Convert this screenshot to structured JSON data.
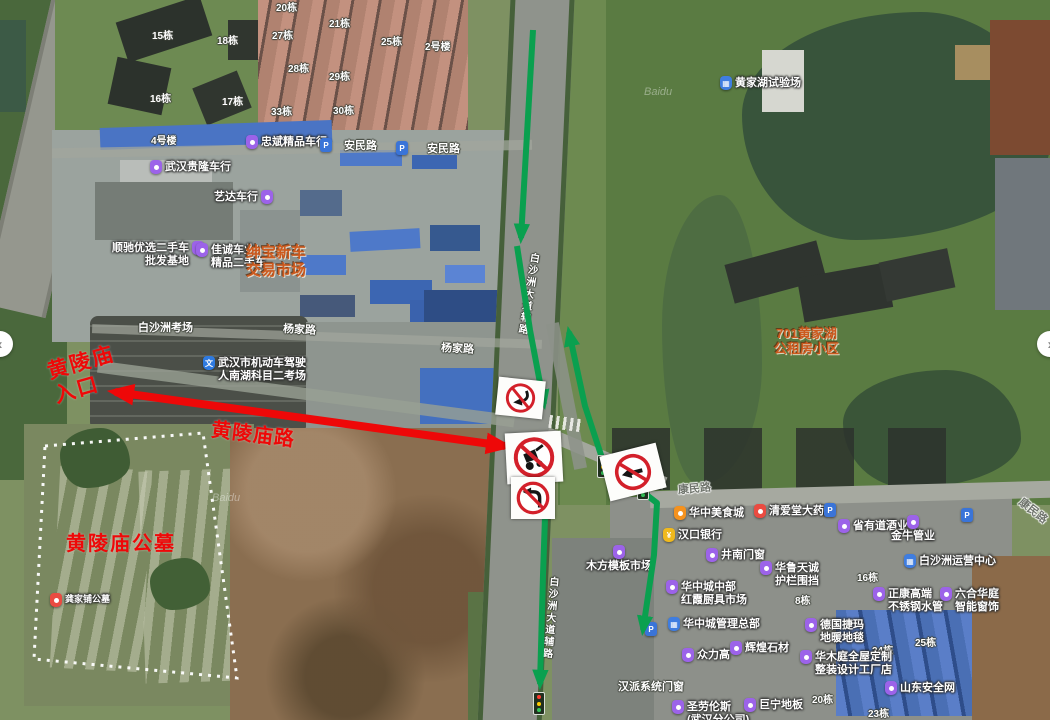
{
  "map": {
    "watermark_text": "Baidu",
    "watermarks": [
      {
        "x": 644,
        "y": 86
      },
      {
        "x": 212,
        "y": 492
      }
    ],
    "controls": {
      "pan_left_glyph": "‹",
      "pan_right_glyph": "›"
    },
    "colors": {
      "annotation_red": "#ee0808",
      "route_green": "#0aa04f",
      "annotation_orange": "#cd5a1e",
      "prohibition_red": "#d3202a"
    },
    "labels": [
      {
        "name": "building-15",
        "type": "bld",
        "x": 152,
        "y": 31,
        "text": "15栋"
      },
      {
        "name": "building-18",
        "type": "bld",
        "x": 217,
        "y": 36,
        "text": "18栋"
      },
      {
        "name": "building-20",
        "type": "bld",
        "x": 276,
        "y": 3,
        "text": "20栋"
      },
      {
        "name": "building-27",
        "type": "bld",
        "x": 272,
        "y": 31,
        "text": "27栋"
      },
      {
        "name": "building-21",
        "type": "bld",
        "x": 329,
        "y": 19,
        "text": "21栋"
      },
      {
        "name": "building-28",
        "type": "bld",
        "x": 288,
        "y": 64,
        "text": "28栋"
      },
      {
        "name": "building-29",
        "type": "bld",
        "x": 329,
        "y": 72,
        "text": "29栋"
      },
      {
        "name": "building-16",
        "type": "bld",
        "x": 150,
        "y": 94,
        "text": "16栋"
      },
      {
        "name": "building-17",
        "type": "bld",
        "x": 222,
        "y": 97,
        "text": "17栋"
      },
      {
        "name": "building-33",
        "type": "bld",
        "x": 271,
        "y": 107,
        "text": "33栋"
      },
      {
        "name": "building-30",
        "type": "bld",
        "x": 333,
        "y": 106,
        "text": "30栋"
      },
      {
        "name": "building-25",
        "type": "bld",
        "x": 381,
        "y": 37,
        "text": "25栋"
      },
      {
        "name": "building-2hao",
        "type": "bld",
        "x": 425,
        "y": 42,
        "text": "2号楼"
      },
      {
        "name": "building-4hao",
        "type": "bld",
        "x": 151,
        "y": 136,
        "text": "4号楼"
      },
      {
        "name": "building-16b",
        "type": "bld",
        "x": 857,
        "y": 573,
        "text": "16栋"
      },
      {
        "name": "building-8",
        "type": "bld",
        "x": 795,
        "y": 596,
        "text": "8栋"
      },
      {
        "name": "building-24",
        "type": "bld",
        "x": 872,
        "y": 646,
        "text": "24栋"
      },
      {
        "name": "building-25b",
        "type": "bld",
        "x": 915,
        "y": 638,
        "text": "25栋"
      },
      {
        "name": "building-20b",
        "type": "bld",
        "x": 812,
        "y": 695,
        "text": "20栋"
      },
      {
        "name": "building-23",
        "type": "bld",
        "x": 868,
        "y": 709,
        "text": "23栋"
      },
      {
        "name": "label-baishazhou-kaochang",
        "type": "road",
        "x": 138,
        "y": 322,
        "text": "白沙洲考场"
      },
      {
        "name": "label-hanpai-doors",
        "type": "road",
        "x": 618,
        "y": 681,
        "text": "汉派系统门窗"
      },
      {
        "name": "road-anmin-1",
        "type": "road",
        "x": 344,
        "y": 140,
        "text": "安民路"
      },
      {
        "name": "road-anmin-2",
        "type": "road",
        "x": 427,
        "y": 143,
        "text": "安民路"
      },
      {
        "name": "road-yangjia-1",
        "type": "road",
        "x": 283,
        "y": 324,
        "rotate": 3,
        "text": "杨家路"
      },
      {
        "name": "road-yangjia-2",
        "type": "road",
        "x": 441,
        "y": 343,
        "rotate": 3,
        "text": "杨家路"
      },
      {
        "name": "road-kangmin-1",
        "type": "roadg",
        "x": 678,
        "y": 483,
        "rotate": -5,
        "text": "康民路"
      },
      {
        "name": "road-kangmin-2",
        "type": "roadg",
        "x": 1016,
        "y": 505,
        "rotate": 38,
        "text": "康民路"
      },
      {
        "name": "road-baishazhou-fulu-north",
        "type": "vroad",
        "x": 521,
        "y": 252,
        "rotate": 9,
        "text": "白沙洲大道辅路"
      },
      {
        "name": "road-baishazhou-fulu-south",
        "type": "vroad",
        "x": 543,
        "y": 576,
        "rotate": 5,
        "text": "白沙洲大道辅路"
      },
      {
        "name": "poi-zhongbin-car",
        "type": "poi",
        "x": 246,
        "y": 136,
        "pin": "purple",
        "text": "忠斌精品车行",
        "interactable": true
      },
      {
        "name": "poi-parking-anmin-1",
        "type": "poi",
        "x": 320,
        "y": 139,
        "pin": "bluep",
        "glyph": "P",
        "text": "",
        "interactable": true
      },
      {
        "name": "poi-parking-anmin-2",
        "type": "poi",
        "x": 396,
        "y": 142,
        "pin": "bluep",
        "glyph": "P",
        "text": "",
        "interactable": true
      },
      {
        "name": "poi-guilong-car",
        "type": "poi",
        "x": 150,
        "y": 161,
        "pin": "purple",
        "text": "武汉贵隆车行",
        "interactable": true
      },
      {
        "name": "poi-yida-car",
        "type": "poi",
        "x": 214,
        "y": 191,
        "pin": "purple",
        "pinSide": "right",
        "text": "艺达车行",
        "interactable": true
      },
      {
        "name": "poi-shunchi-used-cars",
        "type": "poi",
        "x": 112,
        "y": 242,
        "pin": "purple",
        "pinSide": "right",
        "align": "right",
        "lines": [
          "顺驰优选二手车",
          "批发基地"
        ],
        "interactable": true
      },
      {
        "name": "poi-jiacheng-car",
        "type": "poi",
        "x": 196,
        "y": 244,
        "pin": "purple",
        "lines": [
          "佳诚车业",
          "精品二手车"
        ],
        "interactable": true
      },
      {
        "name": "poi-driving-exam-site",
        "type": "poi",
        "x": 203,
        "y": 357,
        "pin": "bluew",
        "glyph": "文",
        "lines": [
          "武汉市机动车驾驶",
          "人南湖科目二考场"
        ],
        "interactable": true
      },
      {
        "name": "poi-huangjiahu-test-ground",
        "type": "poi",
        "x": 720,
        "y": 77,
        "pin": "bluebldg",
        "glyph": "▦",
        "text": "黄家湖试验场",
        "interactable": true
      },
      {
        "name": "poi-huazhong-food-city",
        "type": "poi",
        "x": 674,
        "y": 507,
        "pin": "orange",
        "text": "华中美食城",
        "interactable": true
      },
      {
        "name": "poi-qingaitang-pharmacy",
        "type": "poi",
        "x": 754,
        "y": 505,
        "pin": "red",
        "text": "清爱堂大药房",
        "interactable": true
      },
      {
        "name": "poi-hankou-bank",
        "type": "poi",
        "x": 663,
        "y": 529,
        "pin": "yellow",
        "glyph": "¥",
        "text": "汉口银行",
        "interactable": true
      },
      {
        "name": "poi-shengyoudao-liquor",
        "type": "poi",
        "x": 838,
        "y": 520,
        "pin": "purple",
        "text": "省有道酒业",
        "interactable": true
      },
      {
        "name": "poi-jinniu-pipes",
        "type": "poi",
        "x": 891,
        "y": 516,
        "pin": "purple",
        "pinPos": "top",
        "text": "金牛管业",
        "interactable": true
      },
      {
        "name": "poi-baishazhou-operations-center",
        "type": "poi",
        "x": 904,
        "y": 555,
        "pin": "bluebldg",
        "glyph": "▦",
        "text": "白沙洲运营中心",
        "interactable": true
      },
      {
        "name": "poi-jingnan-doors",
        "type": "poi",
        "x": 706,
        "y": 549,
        "pin": "purple",
        "text": "井南门窗",
        "interactable": true
      },
      {
        "name": "poi-hualu-tiancheng",
        "type": "poi",
        "x": 760,
        "y": 562,
        "pin": "purple",
        "lines": [
          "华鲁天诚",
          "护栏围挡"
        ],
        "interactable": true
      },
      {
        "name": "poi-huazhongcheng-kitchen-market",
        "type": "poi",
        "x": 666,
        "y": 581,
        "pin": "purple",
        "lines": [
          "华中城中部",
          "红霞厨具市场"
        ],
        "interactable": true
      },
      {
        "name": "poi-huazhongcheng-hq",
        "type": "poi",
        "x": 668,
        "y": 618,
        "pin": "bluebldg",
        "glyph": "▦",
        "text": "华中城管理总部",
        "interactable": true
      },
      {
        "name": "poi-zhongligao",
        "type": "poi",
        "x": 682,
        "y": 649,
        "pin": "purple",
        "text": "众力高",
        "interactable": true
      },
      {
        "name": "poi-huihuang-stone",
        "type": "poi",
        "x": 730,
        "y": 642,
        "pin": "purple",
        "text": "辉煌石材",
        "interactable": true
      },
      {
        "name": "poi-deguo-jiema",
        "type": "poi",
        "x": 805,
        "y": 619,
        "pin": "purple",
        "lines": [
          "德国捷玛",
          "地暖地毯"
        ],
        "interactable": true
      },
      {
        "name": "poi-zhengkang-steel",
        "type": "poi",
        "x": 873,
        "y": 588,
        "pin": "purple",
        "lines": [
          "正康高端",
          "不锈钢水管"
        ],
        "interactable": true
      },
      {
        "name": "poi-liuhe-huating",
        "type": "poi",
        "x": 940,
        "y": 588,
        "pin": "purple",
        "lines": [
          "六合华庭",
          "智能窗饰"
        ],
        "interactable": true
      },
      {
        "name": "poi-huamuting-custom",
        "type": "poi",
        "x": 800,
        "y": 651,
        "pin": "purple",
        "lines": [
          "华木庭全屋定制",
          "整装设计工厂店"
        ],
        "interactable": true
      },
      {
        "name": "poi-shandong-safety-net",
        "type": "poi",
        "x": 885,
        "y": 682,
        "pin": "purple",
        "text": "山东安全网",
        "interactable": true
      },
      {
        "name": "poi-juning-floor",
        "type": "poi",
        "x": 744,
        "y": 699,
        "pin": "purple",
        "text": "巨宁地板",
        "interactable": true
      },
      {
        "name": "poi-shenglaolunsi",
        "type": "poi",
        "x": 672,
        "y": 701,
        "pin": "purple",
        "lines": [
          "圣劳伦斯",
          "(武汉分公司)"
        ],
        "interactable": true
      },
      {
        "name": "poi-mufang-timber-market",
        "type": "poi",
        "x": 586,
        "y": 546,
        "pin": "purple",
        "pinPos": "top",
        "text": "木方模板市场",
        "interactable": true
      },
      {
        "name": "poi-parking-kangmin-1",
        "type": "poi",
        "x": 824,
        "y": 504,
        "pin": "bluep",
        "glyph": "P",
        "text": "",
        "interactable": true
      },
      {
        "name": "poi-parking-kangmin-2",
        "type": "poi",
        "x": 961,
        "y": 509,
        "pin": "bluep",
        "glyph": "P",
        "text": "",
        "interactable": true
      },
      {
        "name": "poi-parking-south",
        "type": "poi",
        "x": 645,
        "y": 623,
        "pin": "bluep",
        "glyph": "P",
        "text": "",
        "interactable": true
      },
      {
        "name": "poi-gongjiapu-cemetery",
        "type": "poi small",
        "x": 50,
        "y": 594,
        "pin": "red",
        "text": "龚家铺公墓",
        "interactable": true
      },
      {
        "name": "annotation-shenbao-market",
        "type": "annot-orange",
        "x": 246,
        "y": 244,
        "size": 15,
        "align": "center",
        "lines": [
          "绅宝新车",
          "交易市场"
        ]
      },
      {
        "name": "annotation-701-huangjiahu",
        "type": "annot-orange",
        "x": 774,
        "y": 326,
        "size": 13,
        "align": "center",
        "lines": [
          "701黄家湖",
          "公租房小区"
        ]
      },
      {
        "name": "annotation-huanglingmiao-entrance",
        "type": "annot-red",
        "x": 50,
        "y": 350,
        "size": 21,
        "rotate": -16,
        "ls": 2,
        "lines": [
          "黄陵庙",
          "入口"
        ]
      },
      {
        "name": "annotation-huanglingmiao-road",
        "type": "annot-red",
        "x": 211,
        "y": 423,
        "size": 20,
        "rotate": 7,
        "ls": 1,
        "text": "黄陵庙路"
      },
      {
        "name": "annotation-huanglingmiao-cemetery",
        "type": "annot-red",
        "x": 66,
        "y": 532,
        "size": 20,
        "ls": 2,
        "text": "黄陵庙公墓"
      }
    ],
    "signs": [
      {
        "id": "no-right-curve-sign",
        "kind": "no-curve-left",
        "x": 497,
        "y": 379,
        "w": 43,
        "h": 34,
        "rotate": 6
      },
      {
        "id": "no-carts-sign",
        "kind": "no-cart",
        "x": 506,
        "y": 432,
        "w": 52,
        "h": 47,
        "rotate": -3
      },
      {
        "id": "no-left-turn-sign",
        "kind": "no-left-turn",
        "x": 511,
        "y": 477,
        "w": 40,
        "h": 38,
        "rotate": 0
      },
      {
        "id": "no-left-sign-east",
        "kind": "no-left-straight",
        "x": 604,
        "y": 449,
        "w": 54,
        "h": 42,
        "rotate": -14
      }
    ],
    "traffic_lights": [
      {
        "x": 597,
        "y": 455
      },
      {
        "x": 637,
        "y": 477
      },
      {
        "x": 533,
        "y": 692
      }
    ],
    "routes": {
      "green": [
        {
          "id": "southbound-approach",
          "points": [
            [
              533,
              30
            ],
            [
              521,
              238
            ]
          ],
          "both": false
        },
        {
          "id": "southbound-mid",
          "points": [
            [
              517,
              246
            ],
            [
              530,
              330
            ],
            [
              544,
              404
            ]
          ],
          "both": false
        },
        {
          "id": "southbound-through",
          "points": [
            [
              547,
              459
            ],
            [
              543,
              575
            ],
            [
              540,
              684
            ]
          ],
          "both": false
        },
        {
          "id": "detour-two-way",
          "points": [
            [
              569,
              332
            ],
            [
              585,
              406
            ],
            [
              603,
              461
            ],
            [
              657,
              503
            ],
            [
              654,
              555
            ],
            [
              643,
              630
            ]
          ],
          "both": true
        }
      ],
      "red": [
        {
          "id": "huanglingmiao-road-closed",
          "points": [
            [
              115,
              392
            ],
            [
              505,
              446
            ]
          ],
          "both": true
        }
      ]
    },
    "cemetery_boundary": {
      "points": [
        [
          45,
          446
        ],
        [
          203,
          433
        ],
        [
          237,
          678
        ],
        [
          34,
          659
        ]
      ]
    }
  }
}
